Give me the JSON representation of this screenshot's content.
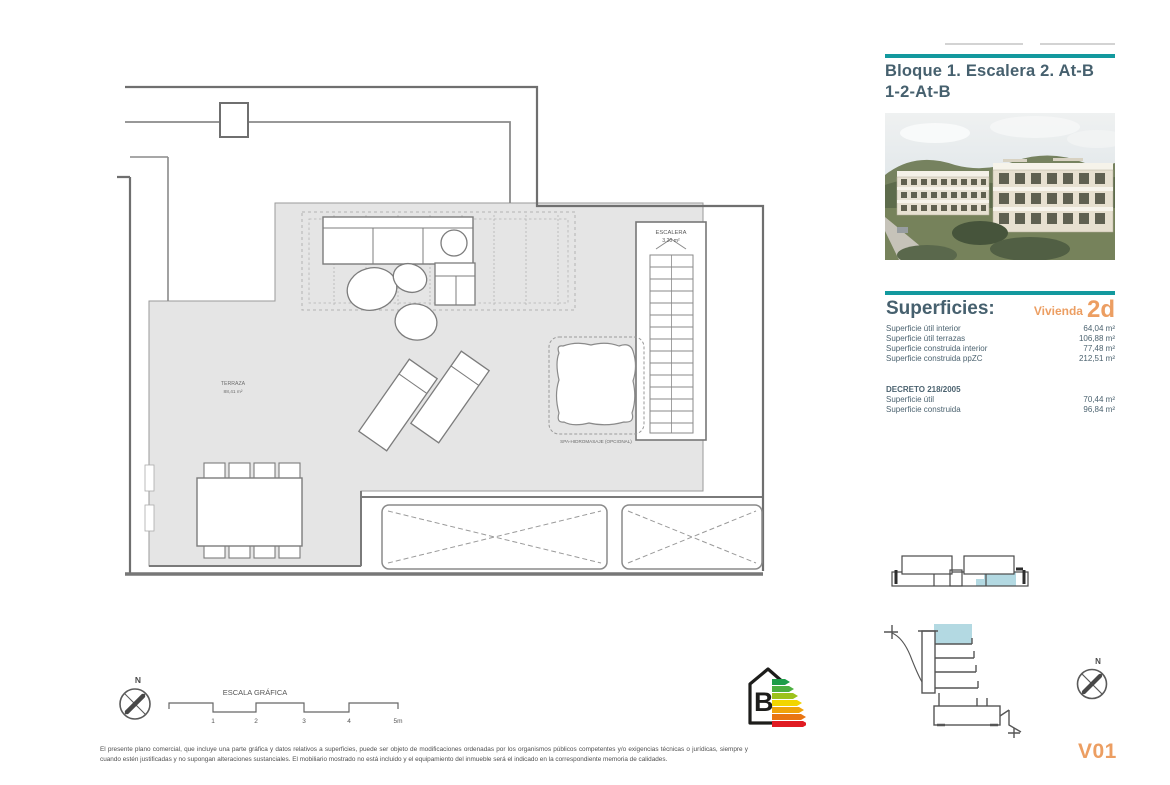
{
  "header": {
    "title_line1": "Bloque 1. Escalera 2. At-B",
    "title_line2": "1-2-At-B"
  },
  "superficies": {
    "heading": "Superficies:",
    "vivienda_label": "Vivienda",
    "vivienda_code": "2d",
    "rows": [
      {
        "label": "Superficie útil interior",
        "value": "64,04 m²"
      },
      {
        "label": "Superficie útil terrazas",
        "value": "106,88 m²"
      },
      {
        "label": "Superficie construida interior",
        "value": "77,48 m²"
      },
      {
        "label": "Superficie construida ppZC",
        "value": "212,51 m²"
      }
    ],
    "decreto_heading": "DECRETO 218/2005",
    "decreto_rows": [
      {
        "label": "Superficie útil",
        "value": "70,44 m²"
      },
      {
        "label": "Superficie construida",
        "value": "96,84 m²"
      }
    ]
  },
  "plan": {
    "terraza_label": "TERRAZA",
    "terraza_area": "88,41 m²",
    "escalera_label": "ESCALERA",
    "escalera_area": "3,20 m²",
    "spa_label": "SPA-HIDROMASAJE (OPCIONAL)"
  },
  "scale_bar": {
    "title": "ESCALA GRÁFICA",
    "ticks": [
      "1",
      "2",
      "3",
      "4",
      "5m"
    ]
  },
  "compass": {
    "north_label": "N"
  },
  "energy": {
    "rating": "B"
  },
  "version": "V01",
  "disclaimer": "El presente plano comercial, que incluye una parte gráfica y datos relativos a superficies, puede ser objeto de modificaciones ordenadas por los organismos públicos competentes y/o exigencias técnicas o jurídicas, siempre y cuando estén justificadas y no supongan alteraciones sustanciales. El mobiliario mostrado no está incluido y el equipamiento del inmueble será el indicado en la correspondiente memoria de calidades.",
  "colors": {
    "teal": "#13999e",
    "slate": "#46606e",
    "orange": "#ec9e62",
    "highlight_blue": "#b3d9e2"
  }
}
